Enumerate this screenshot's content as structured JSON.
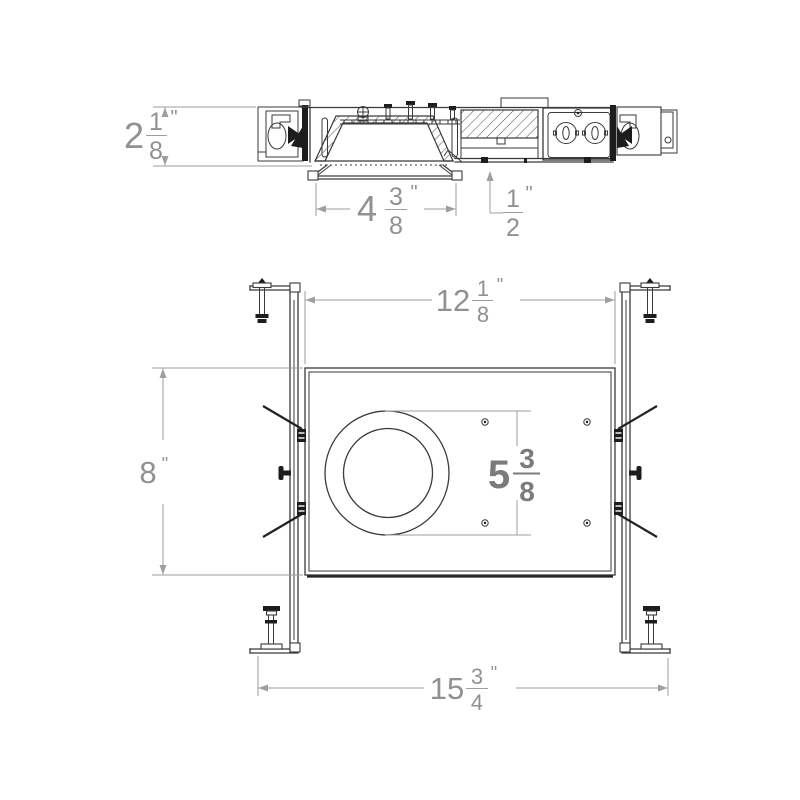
{
  "title": "Recessed downlight frame-in kit dimension drawing",
  "colors": {
    "background": "#ffffff",
    "line": "#3a3a3a",
    "dimension": "#9e9e9e",
    "dimension_bold": "#7b7b7b"
  },
  "side_view": {
    "height": {
      "whole": "2",
      "numerator": "1",
      "denominator": "8",
      "unit": "\""
    },
    "aperture_width": {
      "whole": "4",
      "numerator": "3",
      "denominator": "8",
      "unit": "\""
    },
    "ceiling_offset": {
      "numerator": "1",
      "denominator": "2",
      "unit": "\""
    }
  },
  "plan_view": {
    "plate_width": {
      "whole": "12",
      "numerator": "1",
      "denominator": "8",
      "unit": "\""
    },
    "plate_height": {
      "whole": "8",
      "unit": "\""
    },
    "mount_spacing": {
      "whole": "5",
      "numerator": "3",
      "denominator": "8"
    },
    "overall_width": {
      "whole": "15",
      "numerator": "3",
      "denominator": "4",
      "unit": "\""
    }
  }
}
